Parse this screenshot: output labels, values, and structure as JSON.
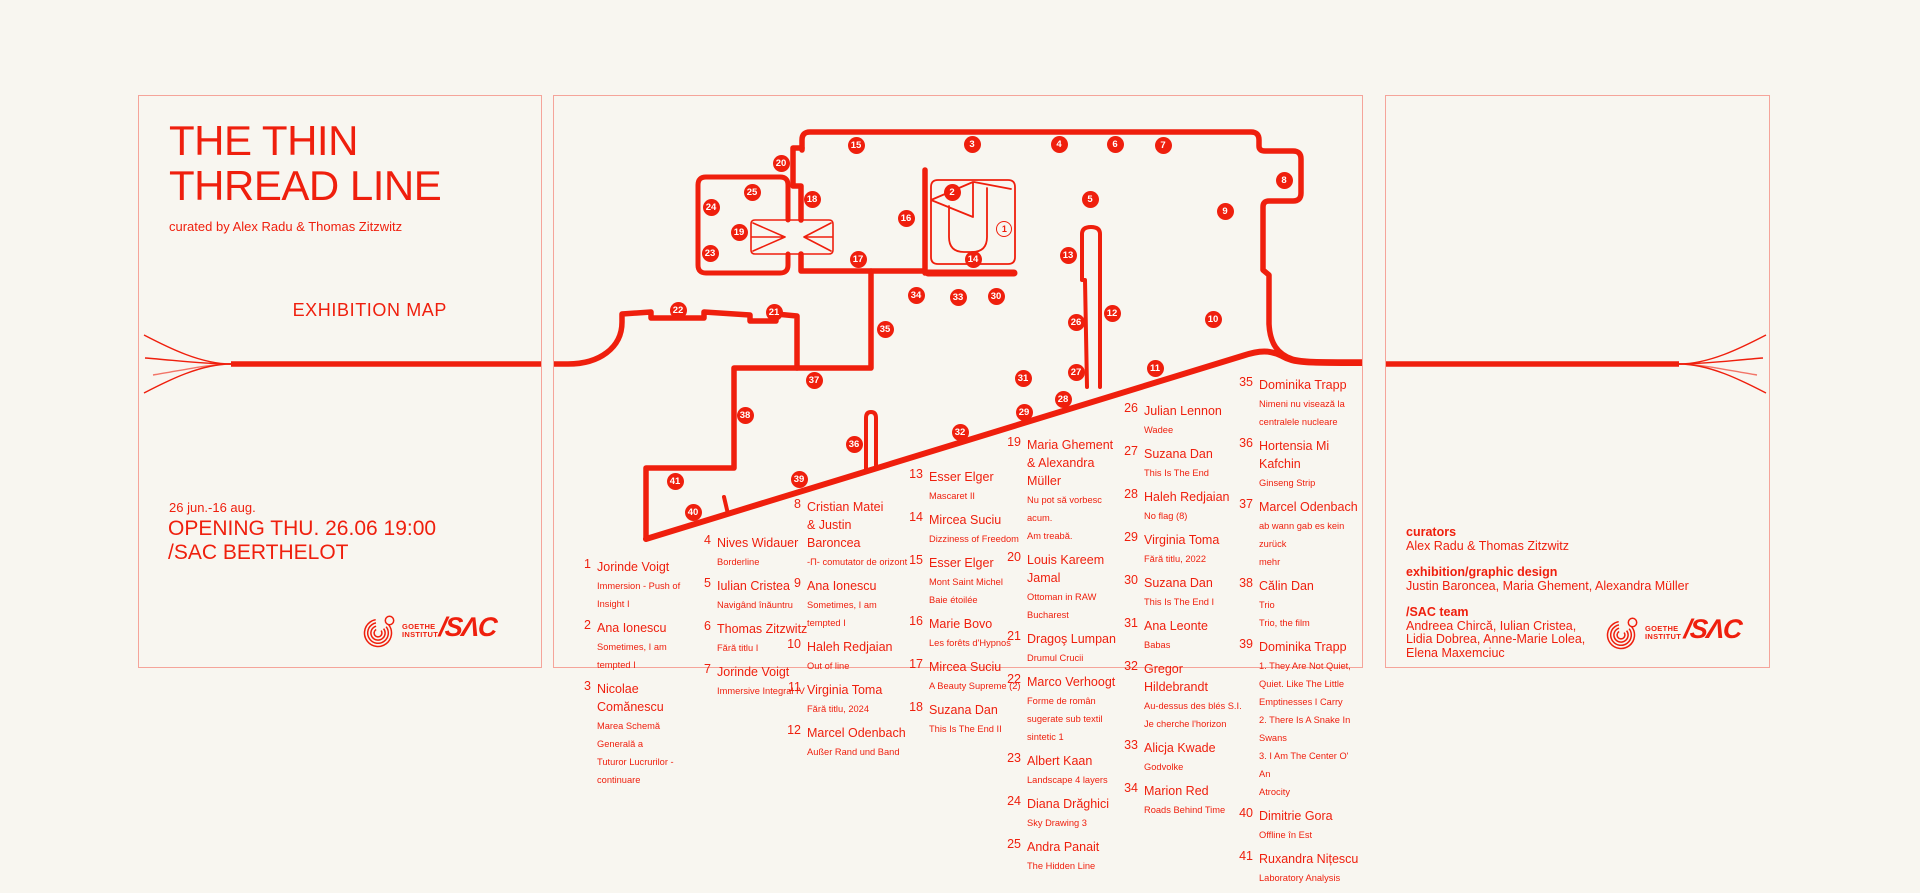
{
  "colors": {
    "red": "#ef1f0d",
    "background": "#f8f6f0",
    "panel_border": "rgba(239,31,13,0.38)"
  },
  "left_panel": {
    "title": "THE THIN\nTHREAD LINE",
    "curated_by": "curated by Alex Radu & Thomas Zitzwitz",
    "exhibition_map_label": "EXHIBITION MAP",
    "dates": "26 jun.-16 aug.",
    "opening_venue": "OPENING THU. 26.06 19:00\n/SAC BERTHELOT"
  },
  "logos": {
    "goethe": "GOETHE\nINSTITUT",
    "sac": "/SΛC"
  },
  "right_panel": {
    "curators_label": "curators",
    "curators": "Alex Radu & Thomas Zitzwitz",
    "design_label": "exhibition/graphic design",
    "design": "Justin Baroncea, Maria Ghement, Alexandra Müller",
    "team_label": "/SAC team",
    "team": "Andreea Chircă, Iulian Cristea,\nLidia Dobrea, Anne-Marie Lolea,\nElena Maxemciuc"
  },
  "map": {
    "markers": [
      {
        "n": 1,
        "x": 451,
        "y": 134,
        "open": true
      },
      {
        "n": 2,
        "x": 398,
        "y": 96
      },
      {
        "n": 3,
        "x": 418,
        "y": 48
      },
      {
        "n": 4,
        "x": 505,
        "y": 48
      },
      {
        "n": 5,
        "x": 536,
        "y": 103
      },
      {
        "n": 6,
        "x": 561,
        "y": 48
      },
      {
        "n": 7,
        "x": 609,
        "y": 49
      },
      {
        "n": 8,
        "x": 730,
        "y": 84
      },
      {
        "n": 9,
        "x": 671,
        "y": 115
      },
      {
        "n": 10,
        "x": 659,
        "y": 223
      },
      {
        "n": 11,
        "x": 601,
        "y": 272
      },
      {
        "n": 12,
        "x": 558,
        "y": 217
      },
      {
        "n": 13,
        "x": 514,
        "y": 159
      },
      {
        "n": 14,
        "x": 419,
        "y": 163
      },
      {
        "n": 15,
        "x": 302,
        "y": 49
      },
      {
        "n": 16,
        "x": 352,
        "y": 122
      },
      {
        "n": 17,
        "x": 304,
        "y": 163
      },
      {
        "n": 18,
        "x": 258,
        "y": 103
      },
      {
        "n": 19,
        "x": 185,
        "y": 136
      },
      {
        "n": 20,
        "x": 227,
        "y": 67
      },
      {
        "n": 21,
        "x": 220,
        "y": 216
      },
      {
        "n": 22,
        "x": 124,
        "y": 214
      },
      {
        "n": 23,
        "x": 156,
        "y": 157
      },
      {
        "n": 24,
        "x": 157,
        "y": 111
      },
      {
        "n": 25,
        "x": 198,
        "y": 96
      },
      {
        "n": 26,
        "x": 522,
        "y": 226
      },
      {
        "n": 27,
        "x": 522,
        "y": 276
      },
      {
        "n": 28,
        "x": 509,
        "y": 303
      },
      {
        "n": 29,
        "x": 470,
        "y": 316
      },
      {
        "n": 30,
        "x": 442,
        "y": 200
      },
      {
        "n": 31,
        "x": 469,
        "y": 282
      },
      {
        "n": 32,
        "x": 406,
        "y": 336
      },
      {
        "n": 33,
        "x": 404,
        "y": 201
      },
      {
        "n": 34,
        "x": 362,
        "y": 199
      },
      {
        "n": 35,
        "x": 331,
        "y": 233
      },
      {
        "n": 36,
        "x": 300,
        "y": 348
      },
      {
        "n": 37,
        "x": 260,
        "y": 284
      },
      {
        "n": 38,
        "x": 191,
        "y": 319
      },
      {
        "n": 39,
        "x": 245,
        "y": 383
      },
      {
        "n": 40,
        "x": 139,
        "y": 416
      },
      {
        "n": 41,
        "x": 121,
        "y": 385
      }
    ]
  },
  "artists": [
    {
      "x": 22,
      "y": 462,
      "items": [
        {
          "n": 1,
          "name": "Jorinde Voigt",
          "titles": [
            "Immersion - Push of Insight I"
          ]
        },
        {
          "n": 2,
          "name": "Ana Ionescu",
          "titles": [
            "Sometimes, I am tempted I"
          ]
        },
        {
          "n": 3,
          "name": "Nicolae Comănescu",
          "titles": [
            "Marea Schemă Generală a",
            "Tuturor Lucrurilor - continuare"
          ]
        }
      ]
    },
    {
      "x": 142,
      "y": 438,
      "items": [
        {
          "n": 4,
          "name": "Nives Widauer",
          "titles": [
            "Borderline"
          ]
        },
        {
          "n": 5,
          "name": "Iulian Cristea",
          "titles": [
            "Navigând înăuntru"
          ]
        },
        {
          "n": 6,
          "name": "Thomas Zitzwitz",
          "titles": [
            "Fără titlu I"
          ]
        },
        {
          "n": 7,
          "name": "Jorinde Voigt",
          "titles": [
            "Immersive Integral IV"
          ]
        }
      ]
    },
    {
      "x": 232,
      "y": 402,
      "items": [
        {
          "n": 8,
          "name": "Cristian Matei\n& Justin Baroncea",
          "titles": [
            "-Π- comutator de orizont"
          ]
        },
        {
          "n": 9,
          "name": "Ana Ionescu",
          "titles": [
            "Sometimes, I am tempted I"
          ]
        },
        {
          "n": 10,
          "name": "Haleh Redjaian",
          "titles": [
            "Out of line"
          ]
        },
        {
          "n": 11,
          "name": "Virginia Toma",
          "titles": [
            "Fără titlu, 2024"
          ]
        },
        {
          "n": 12,
          "name": "Marcel Odenbach",
          "titles": [
            "Außer Rand und Band"
          ]
        }
      ]
    },
    {
      "x": 354,
      "y": 372,
      "items": [
        {
          "n": 13,
          "name": "Esser Elger",
          "titles": [
            "Mascaret II"
          ]
        },
        {
          "n": 14,
          "name": "Mircea Suciu",
          "titles": [
            "Dizziness of Freedom"
          ]
        },
        {
          "n": 15,
          "name": "Esser Elger",
          "titles": [
            "Mont Saint Michel",
            "Baie étoilée"
          ]
        },
        {
          "n": 16,
          "name": "Marie Bovo",
          "titles": [
            "Les forêts d'Hypnos"
          ]
        },
        {
          "n": 17,
          "name": "Mircea Suciu",
          "titles": [
            "A Beauty Supreme (2)"
          ]
        },
        {
          "n": 18,
          "name": "Suzana Dan",
          "titles": [
            "This Is The End II"
          ]
        }
      ]
    },
    {
      "x": 452,
      "y": 340,
      "items": [
        {
          "n": 19,
          "name": "Maria Ghement\n& Alexandra Müller",
          "titles": [
            "Nu pot să vorbesc acum.",
            "Am treabă."
          ]
        },
        {
          "n": 20,
          "name": "Louis Kareem Jamal",
          "titles": [
            "Ottoman in RAW Bucharest"
          ]
        },
        {
          "n": 21,
          "name": "Dragoş Lumpan",
          "titles": [
            "Drumul Crucii"
          ]
        },
        {
          "n": 22,
          "name": "Marco Verhoogt",
          "titles": [
            "Forme de român",
            "sugerate sub textil sintetic 1"
          ]
        },
        {
          "n": 23,
          "name": "Albert Kaan",
          "titles": [
            "Landscape 4 layers"
          ]
        },
        {
          "n": 24,
          "name": "Diana Drăghici",
          "titles": [
            "Sky Drawing 3"
          ]
        },
        {
          "n": 25,
          "name": "Andra Panait",
          "titles": [
            "The Hidden Line"
          ]
        }
      ]
    },
    {
      "x": 569,
      "y": 306,
      "items": [
        {
          "n": 26,
          "name": "Julian Lennon",
          "titles": [
            "Wadee"
          ]
        },
        {
          "n": 27,
          "name": "Suzana Dan",
          "titles": [
            "This Is The End"
          ]
        },
        {
          "n": 28,
          "name": "Haleh Redjaian",
          "titles": [
            "No flag (8)"
          ]
        },
        {
          "n": 29,
          "name": "Virginia Toma",
          "titles": [
            "Fără titlu, 2022"
          ]
        },
        {
          "n": 30,
          "name": "Suzana Dan",
          "titles": [
            "This Is The End I"
          ]
        },
        {
          "n": 31,
          "name": "Ana Leonte",
          "titles": [
            "Babas"
          ]
        },
        {
          "n": 32,
          "name": "Gregor Hildebrandt",
          "titles": [
            "Au-dessus des blés S.I.",
            "Je cherche l'horizon"
          ]
        },
        {
          "n": 33,
          "name": "Alicja Kwade",
          "titles": [
            "Godvolke"
          ]
        },
        {
          "n": 34,
          "name": "Marion Red",
          "titles": [
            "Roads Behind Time"
          ]
        }
      ]
    },
    {
      "x": 684,
      "y": 280,
      "items": [
        {
          "n": 35,
          "name": "Dominika Trapp",
          "titles": [
            "Nimeni nu visează la",
            "centralele nucleare"
          ]
        },
        {
          "n": 36,
          "name": "Hortensia Mi Kafchin",
          "titles": [
            "Ginseng Strip"
          ]
        },
        {
          "n": 37,
          "name": "Marcel Odenbach",
          "titles": [
            "ab wann gab es kein zurück",
            "mehr"
          ]
        },
        {
          "n": 38,
          "name": "Călin Dan",
          "titles": [
            "Trio",
            "Trio, the film"
          ]
        },
        {
          "n": 39,
          "name": "Dominika Trapp",
          "titles": [
            "1. They Are Not Quiet,",
            "Quiet. Like The Little",
            "Emptinesses I Carry",
            "2. There Is A Snake In",
            "Swans",
            "3. I Am The Center O' An",
            "Atrocity"
          ]
        },
        {
          "n": 40,
          "name": "Dimitrie Gora",
          "titles": [
            "Offline în Est"
          ]
        },
        {
          "n": 41,
          "name": "Ruxandra Nițescu",
          "titles": [
            "Laboratory Analysis"
          ]
        }
      ]
    }
  ]
}
